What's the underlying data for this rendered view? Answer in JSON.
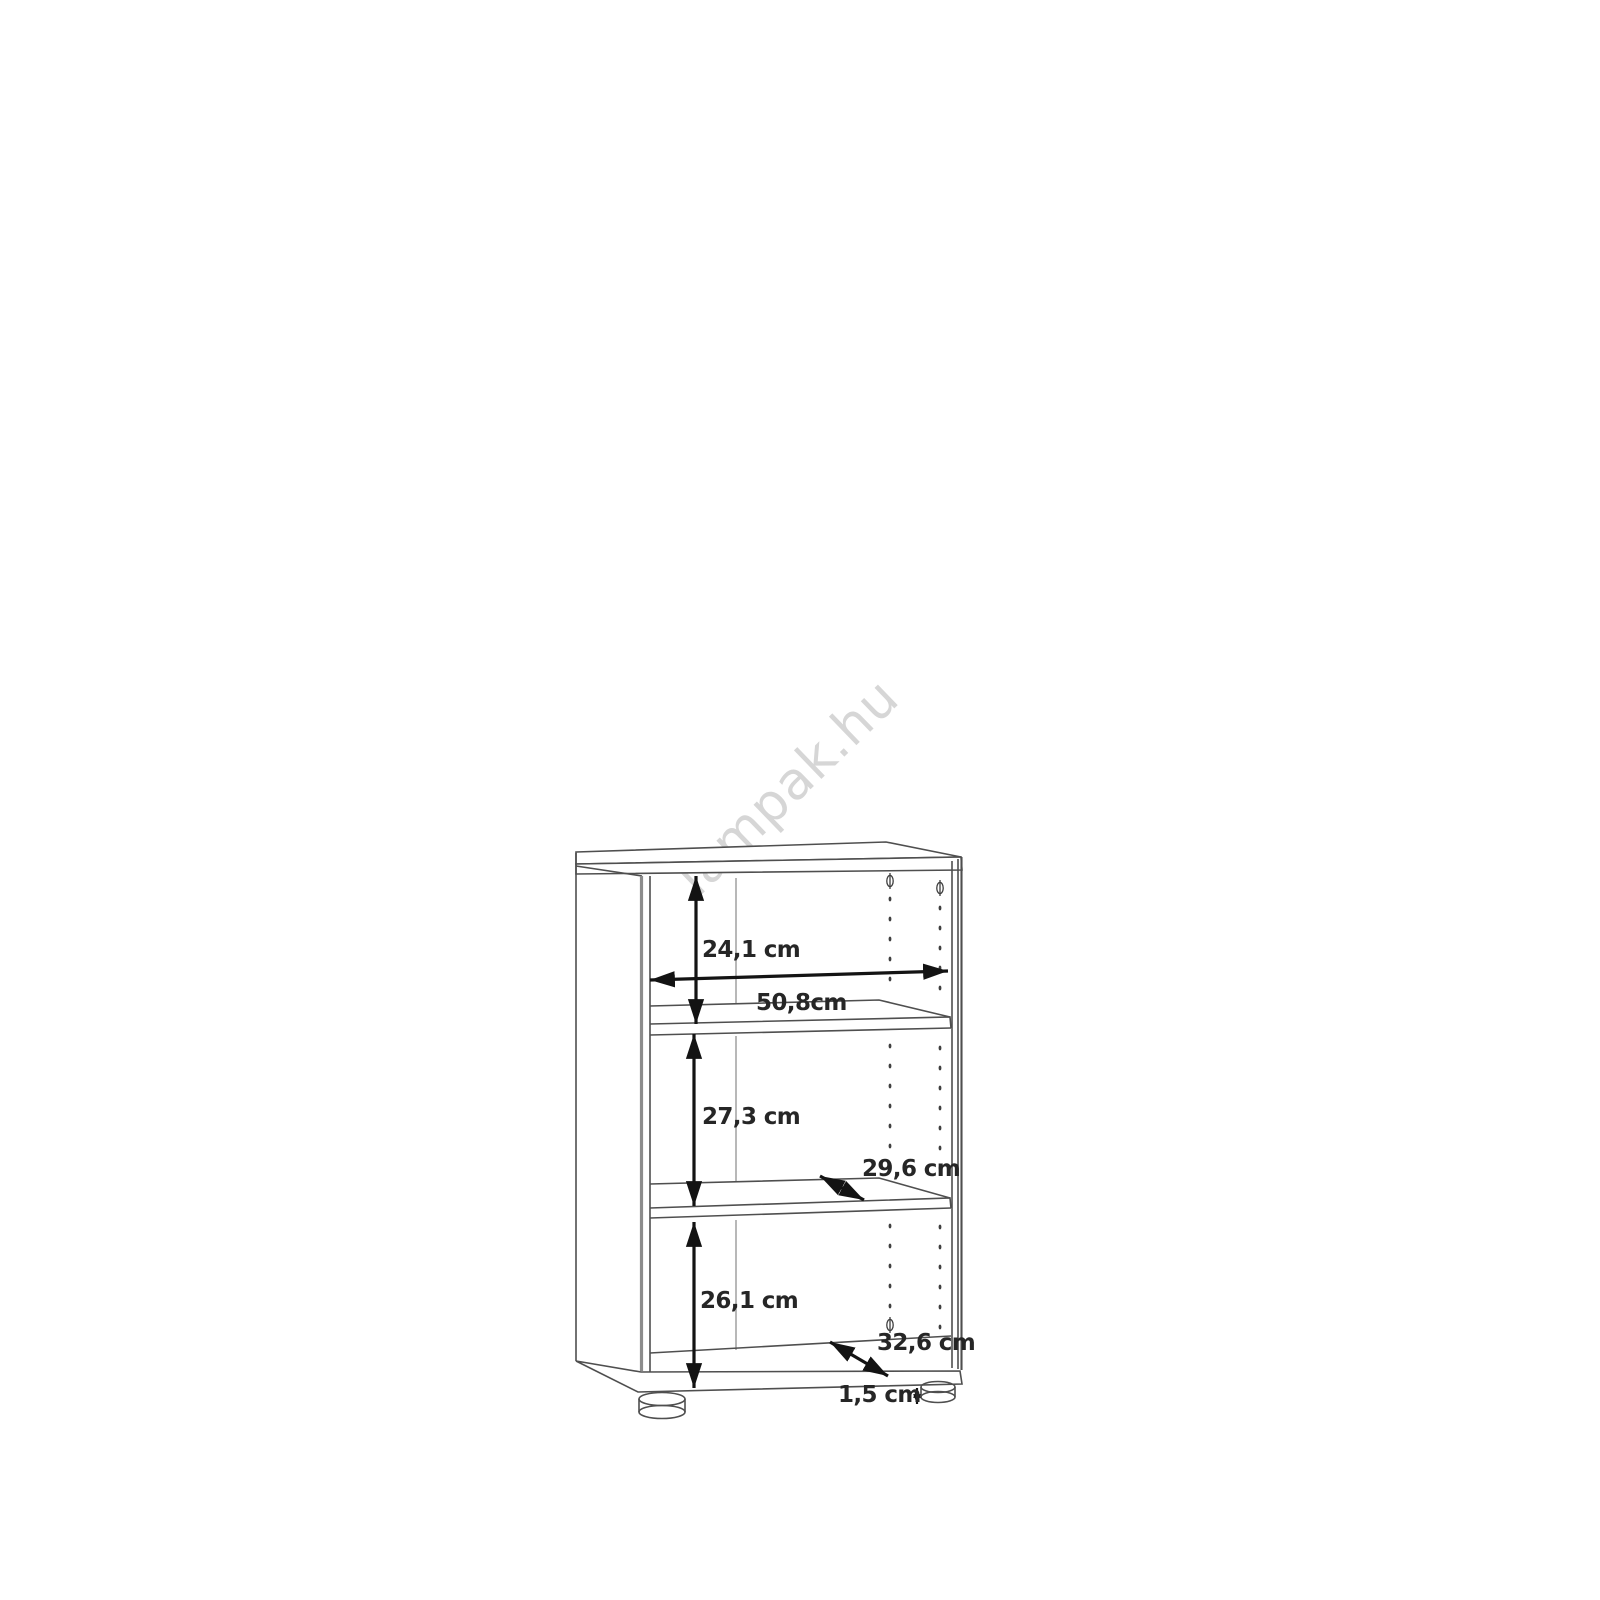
{
  "page": {
    "background": "#ffffff",
    "description": "Product dimension diagram of a two-shelf open bookcase with adjustable shelf pin holes and plastic feet"
  },
  "watermark": {
    "text": "lampak.hu",
    "color": "#d6d6d6"
  },
  "dimensions": {
    "top_section_height": "24,1 cm",
    "interior_width": "50,8cm",
    "middle_section_height": "27,3 cm",
    "shelf_depth": "29,6 cm",
    "bottom_section_height": "26,1 cm",
    "bottom_panel_depth": "32,6 cm",
    "foot_height": "1,5 cm"
  },
  "colors": {
    "outline": "#4f4f4f",
    "panel_edge_gray": "#8c8c8c",
    "dimension_lines": "#131313",
    "label_text": "#262626",
    "watermark": "#d6d6d6"
  }
}
